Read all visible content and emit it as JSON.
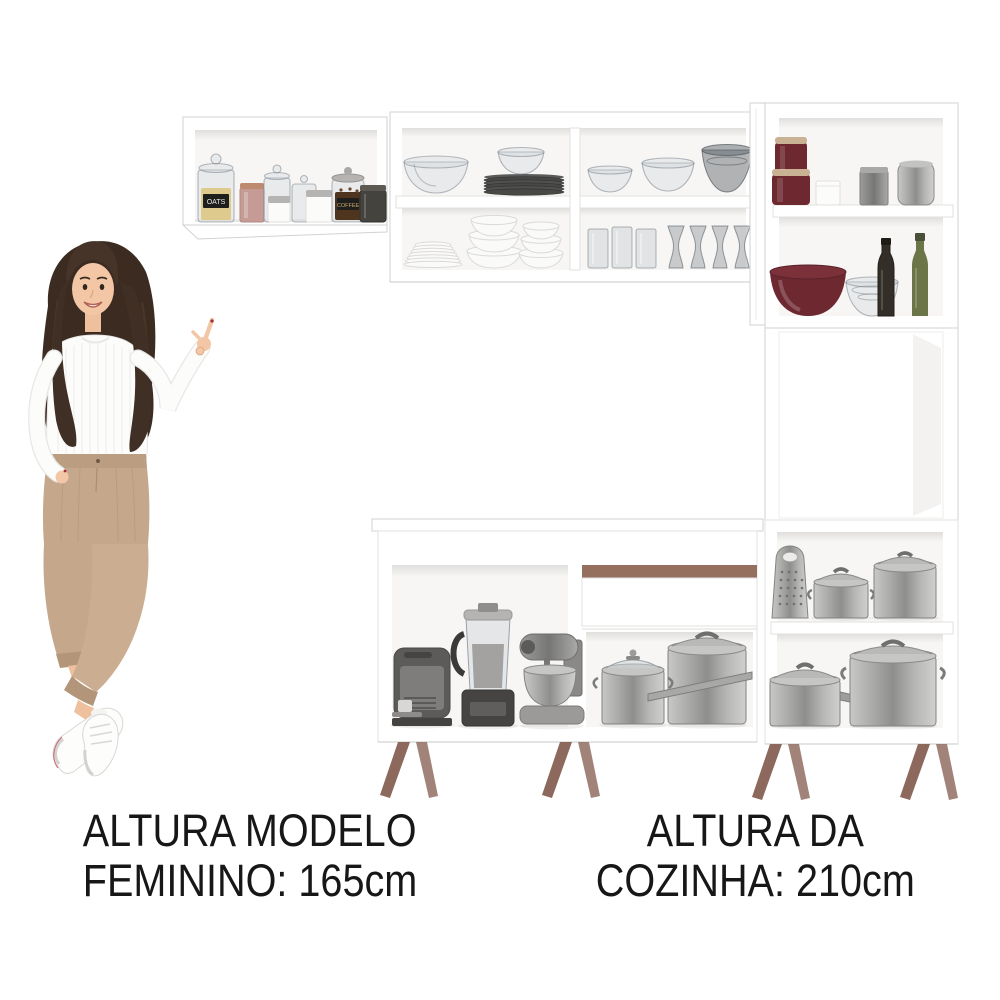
{
  "captions": {
    "model_line1": "ALTURA MODELO",
    "model_line2": "FEMININO: 165cm",
    "kitchen_line1": "ALTURA DA",
    "kitchen_line2": "COZINHA: 210cm"
  },
  "jar_labels": {
    "oats": "OATS",
    "coffee": "COFFEE"
  },
  "colors": {
    "accent_brown": "#96705e",
    "leg_wood": "#8d685c",
    "burgundy": "#6d2830",
    "olive_green": "#6c7548",
    "caption_text": "#171717",
    "background": "#ffffff"
  }
}
